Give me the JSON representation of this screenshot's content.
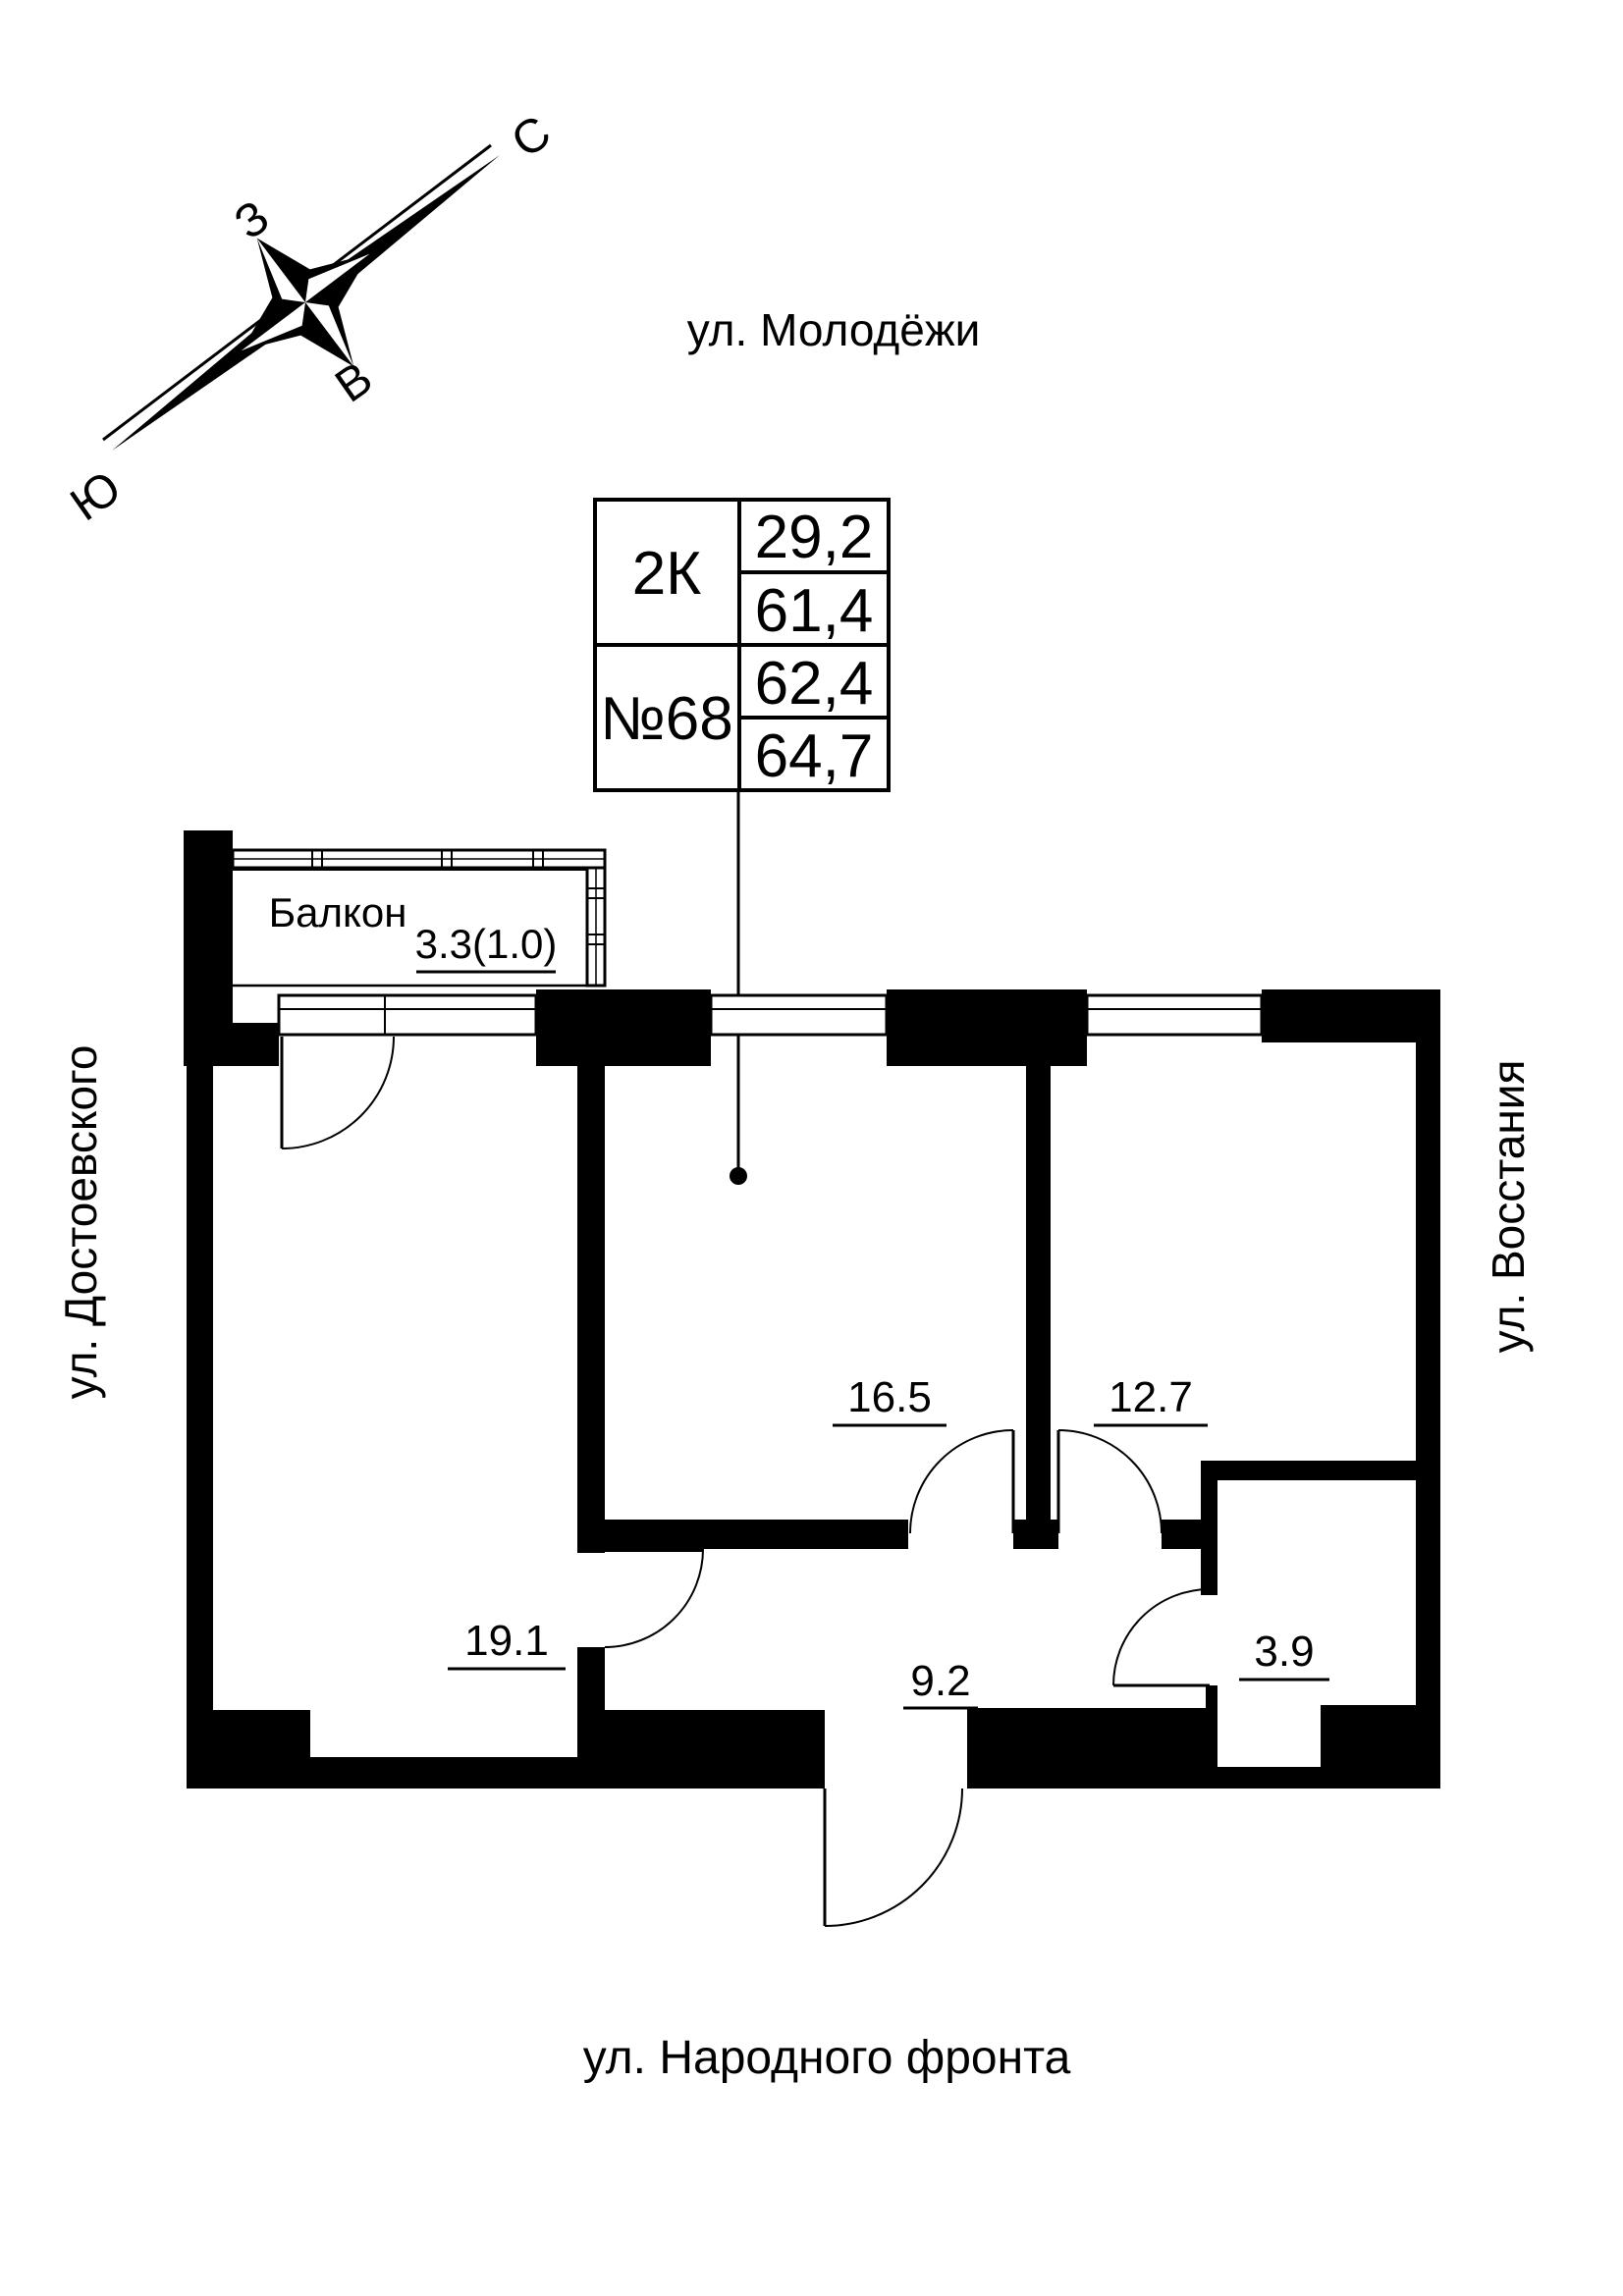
{
  "title": "Floor plan apartment 2K No.68",
  "compass": {
    "north": "С",
    "south": "Ю",
    "west": "З",
    "east": "В"
  },
  "streets": {
    "top": "ул. Молодёжи",
    "left": "ул. Достоевского",
    "right": "ул. Восстания",
    "bottom": "ул. Народного фронта"
  },
  "info_table": {
    "unit_type": "2К",
    "unit_number": "№68",
    "values": [
      "29,2",
      "61,4",
      "62,4",
      "64,7"
    ]
  },
  "rooms": [
    {
      "name": "balcony",
      "label": "Балкон",
      "area": "3.3(1.0)"
    },
    {
      "name": "living-room",
      "label": "",
      "area": "19.1"
    },
    {
      "name": "room-16-5",
      "label": "",
      "area": "16.5"
    },
    {
      "name": "room-12-7",
      "label": "",
      "area": "12.7"
    },
    {
      "name": "hallway",
      "label": "",
      "area": "9.2"
    },
    {
      "name": "bathroom",
      "label": "",
      "area": "3.9"
    }
  ],
  "colors": {
    "walls": "#000000",
    "background": "#ffffff"
  }
}
